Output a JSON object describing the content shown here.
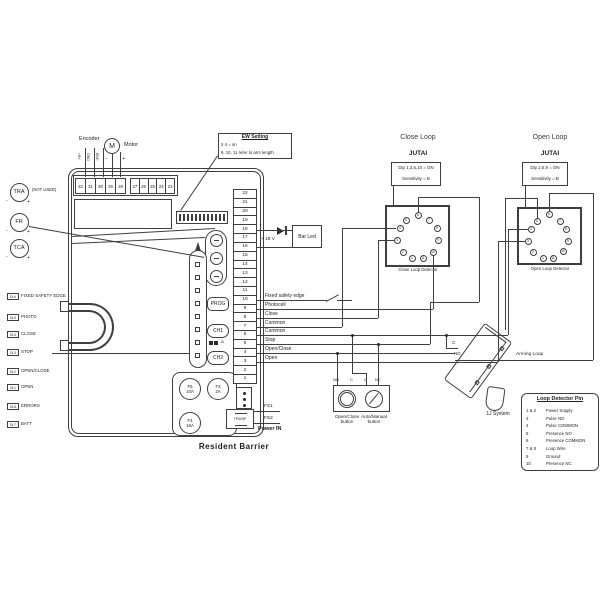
{
  "diagram": {
    "board": {
      "title": "Resident Barrier",
      "encoder": {
        "label": "Encoder",
        "wire_labels": [
          "+8V",
          "GND",
          "ENC"
        ]
      },
      "motor": {
        "label": "Motor",
        "symbol": "M",
        "minus": "-",
        "plus": "+"
      },
      "top_terminals": [
        "32",
        "31",
        "30",
        "29",
        "28",
        "27",
        "26",
        "25",
        "24",
        "23"
      ],
      "ew_setting": {
        "title": "EW Setting",
        "lines": [
          "2 4 = on",
          "9, 10, 11 refer to arm length"
        ]
      },
      "terminal_rows": [
        "22",
        "21",
        "20",
        "19",
        "18",
        "17",
        "16",
        "15",
        "14",
        "13",
        "12",
        "11",
        "10",
        "9",
        "8",
        "7",
        "6",
        "5",
        "4",
        "3",
        "2",
        "1"
      ],
      "row_labels": [
        "Fixed safety edge",
        "Photocell",
        "Close",
        "Common",
        "Common",
        "Stop",
        "Open/Close",
        "Open"
      ],
      "bar_led": {
        "label": "Bar Led",
        "minus": "-",
        "plus": "+ 18 V"
      },
      "prog": "PROG",
      "ch1": "CH1",
      "ch2": "CH2",
      "jumper": "J4",
      "fuses": [
        [
          "F5",
          "10A"
        ],
        [
          "F3",
          "2A"
        ],
        [
          "F4",
          "16A"
        ]
      ],
      "trasf": "TRASF",
      "fs1": "FS1",
      "fs2": "FS2",
      "power_in": "Power IN"
    },
    "left": {
      "dials": [
        {
          "label": "TRA",
          "note": "(NOT USED)",
          "minus": "-",
          "plus": "+"
        },
        {
          "label": "FR",
          "minus": "-",
          "plus": "+"
        },
        {
          "label": "TCA",
          "minus": "-",
          "plus": "+"
        }
      ],
      "leds": [
        [
          "DL6",
          "FIXED SAFETY EDGE"
        ],
        [
          "DL5",
          "PHOTO"
        ],
        [
          "DL4",
          "CLOSE"
        ],
        [
          "DL3",
          "STOP"
        ],
        [
          "DL2",
          "OPEN/CLOSE"
        ],
        [
          "DL1",
          "OPEN"
        ],
        [
          "DL8",
          "ERRORS"
        ],
        [
          "DL7",
          "BATT"
        ]
      ]
    },
    "close_loop": {
      "title": "Close Loop",
      "brand": "JUTAI",
      "dip": "Dip 1,3,5,10 = ON",
      "sens": "Sensitivity = B",
      "caption": "Close Loop Detector",
      "pin_order": [
        "6",
        "5",
        "7",
        "4",
        "8",
        "3",
        "9",
        "2",
        "10",
        "1",
        "11"
      ]
    },
    "open_loop": {
      "title": "Open Loop",
      "brand": "JUTAI",
      "dip": "Dip 2,5,9 = ON",
      "sens": "Sensitivity = B",
      "caption": "Open Loop Detector",
      "pin_order": [
        "6",
        "5",
        "7",
        "4",
        "8",
        "3",
        "9",
        "2",
        "10",
        "1",
        "11"
      ]
    },
    "buttons": {
      "terminals": [
        "NO",
        "C",
        "C",
        "NC"
      ],
      "b1": [
        "Open/Close",
        "button"
      ],
      "b2": [
        "Auto/Manual",
        "button"
      ]
    },
    "arming": {
      "label": "Arming Loop",
      "device": "1J System",
      "c": "C",
      "no": "NO"
    },
    "pin_table": {
      "title": "Loop Detector Pin",
      "rows": [
        [
          "1 & 2",
          "Power Supply"
        ],
        [
          "3",
          "Pulse NO"
        ],
        [
          "4",
          "Pulse COMMON"
        ],
        [
          "5",
          "Presence NO"
        ],
        [
          "6",
          "Presence COMMON"
        ],
        [
          "7 & 8",
          "Loop Wire"
        ],
        [
          "9",
          "Ground"
        ],
        [
          "10",
          "Presence NC"
        ]
      ]
    }
  }
}
